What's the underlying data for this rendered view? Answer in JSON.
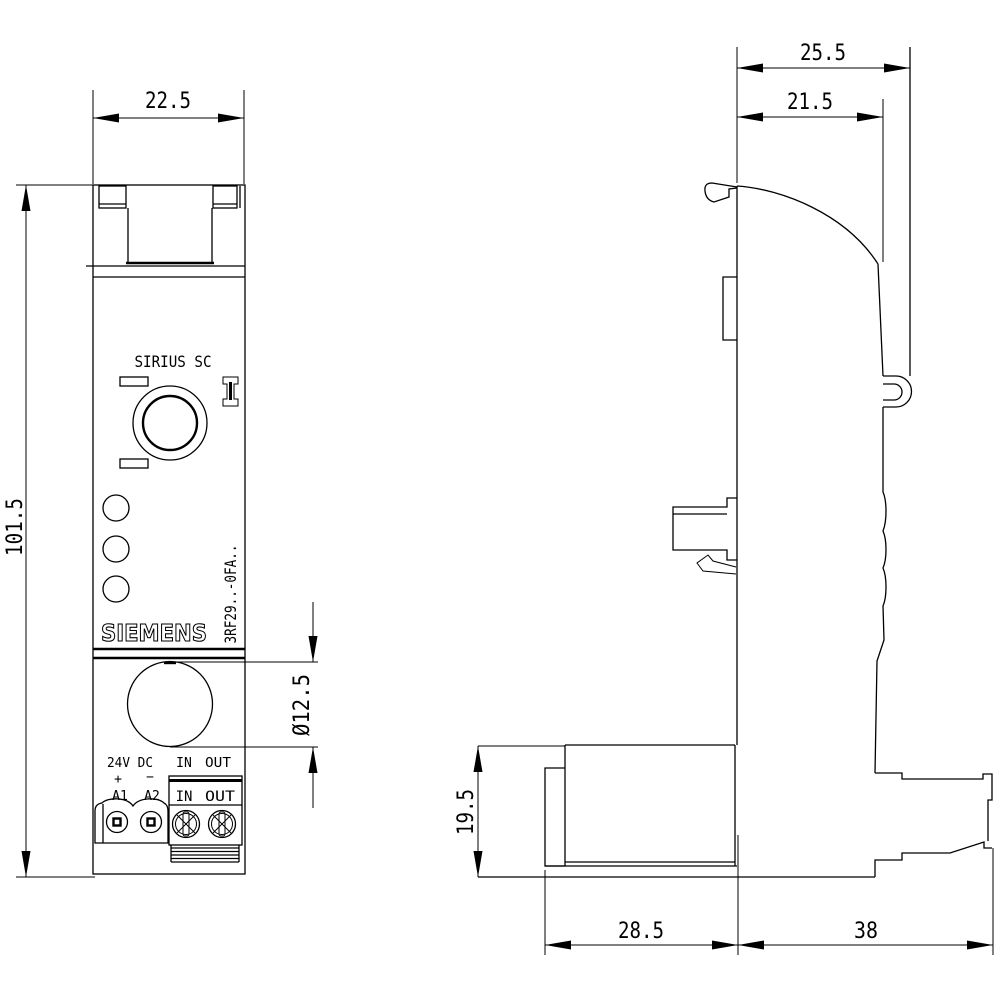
{
  "front_view": {
    "product_line": "SIRIUS SC",
    "brand": "SIEMENS",
    "model": "3RF29..-0FA..",
    "terminals": {
      "supply": "24V DC",
      "plus": "+",
      "minus": "−",
      "a1": "A1",
      "a2": "A2",
      "in_label": "IN",
      "out_label": "OUT",
      "in_block": "IN",
      "out_block": "OUT"
    }
  },
  "dimensions_mm": {
    "overall_width": "22.5",
    "overall_height": "101.5",
    "knob_diameter": "Ø12.5",
    "depth_overall": "25.5",
    "depth_body": "21.5",
    "terminal_height": "19.5",
    "depth_front": "28.5",
    "depth_rear": "38"
  },
  "colors": {
    "line": "#000000",
    "background": "#ffffff"
  }
}
